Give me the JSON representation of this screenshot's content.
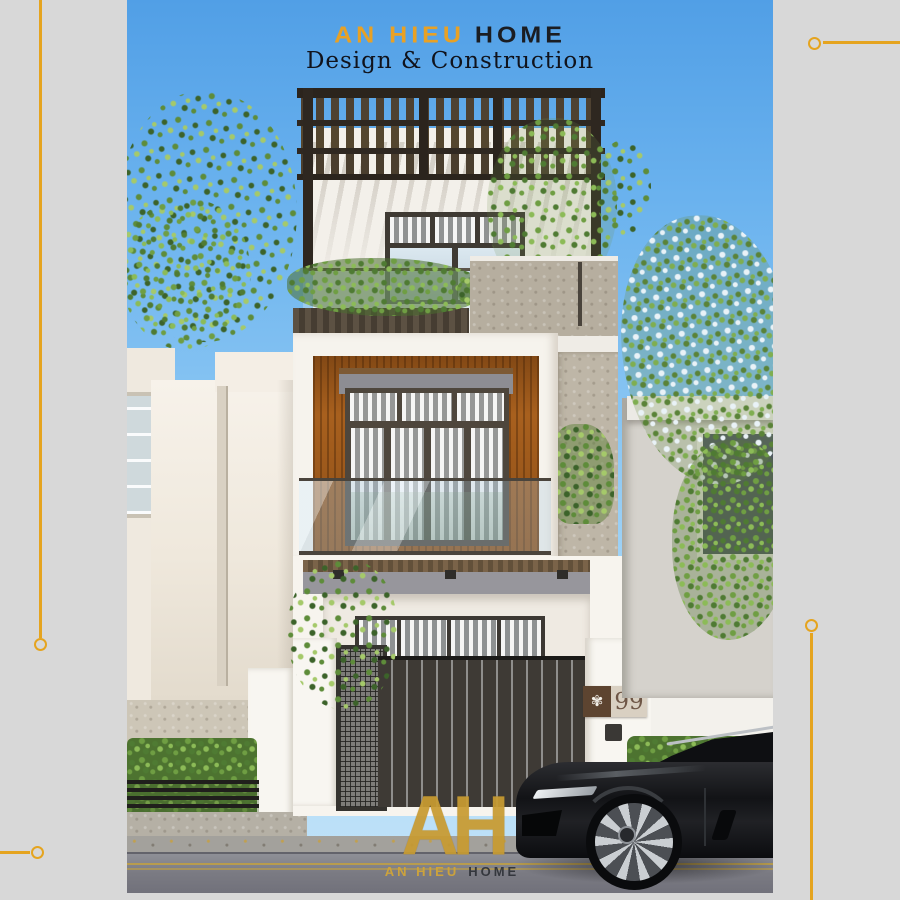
{
  "header": {
    "brand_primary": "AN HIEU",
    "brand_secondary": "HOME",
    "tagline": "Design & Construction"
  },
  "house": {
    "number_plate": "99",
    "plate_emblem_glyph": "✾"
  },
  "watermark": {
    "monogram": "AH",
    "brand_primary": "AN HIEU",
    "brand_secondary": "HOME"
  },
  "colors": {
    "accent_gold": "#E5A41F",
    "frame_gray": "#D8D8D8",
    "brand_orange": "#E8A125",
    "brand_dark": "#1B1D22",
    "sky_top": "#519FE6",
    "sky_bottom": "#C2E3F9",
    "wood_accent_panel": "#A8601E",
    "pergola_wood": "#352C23",
    "watermark_gold": "#C89B31"
  }
}
